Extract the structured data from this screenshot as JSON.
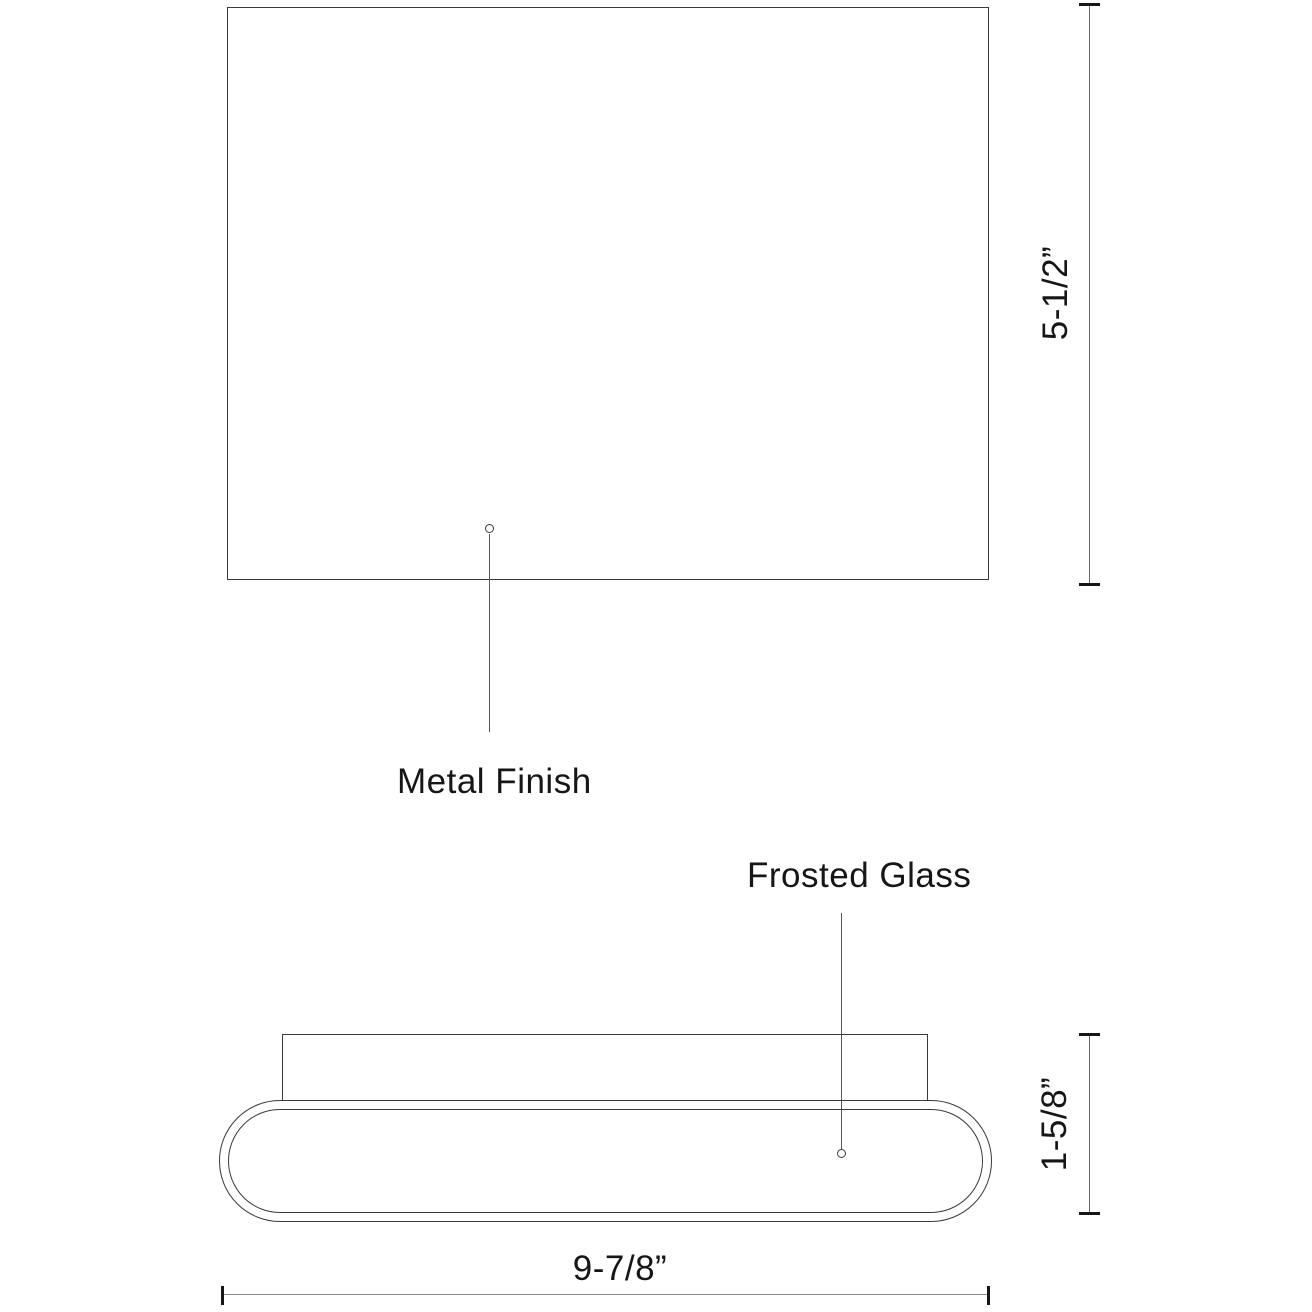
{
  "diagram": {
    "type": "product-dimension-drawing",
    "product": "wall sconce light fixture",
    "front_view": {
      "callout_label": "Metal Finish",
      "height_dimension": "5-1/2”"
    },
    "profile_view": {
      "callout_label": "Frosted Glass",
      "depth_dimension": "1-5/8”",
      "width_dimension": "9-7/8”"
    },
    "colors": {
      "background": "#ffffff",
      "outline": "#3a3a3a",
      "dimension_line": "#6a6a6a",
      "tick": "#161616",
      "text": "#161616"
    }
  }
}
